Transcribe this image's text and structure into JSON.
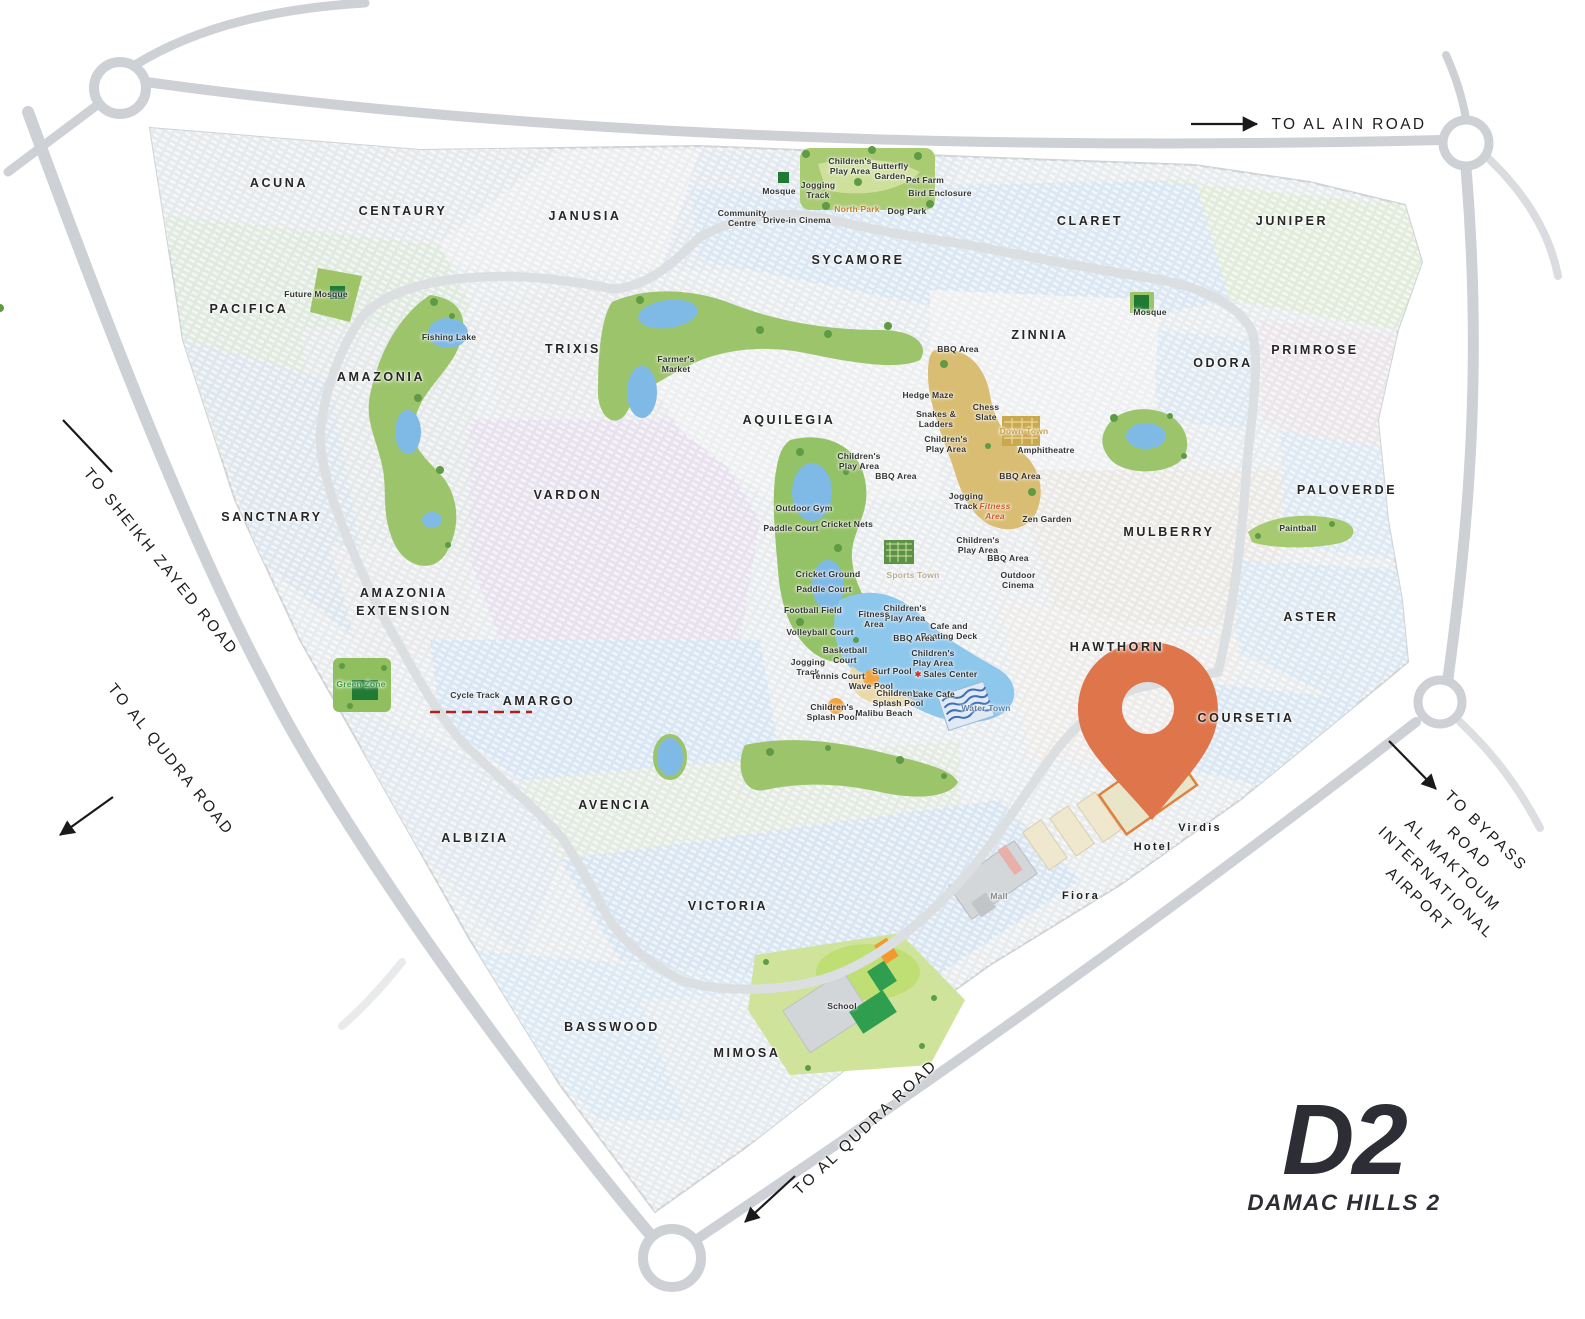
{
  "brand": {
    "logo_main": "D2",
    "logo_sub": "DAMAC HILLS 2"
  },
  "colors": {
    "pin": "#DE754B",
    "loop_dashed_road": "#B02020",
    "highway": "#CDD0D4",
    "park_green": "#9CC56B",
    "lake_blue": "#7FB9E6",
    "logo": "#2D2D35",
    "accent_orange_label": "#C2802F"
  },
  "clusters": [
    {
      "n": "ACUNA",
      "x": 279,
      "y": 183
    },
    {
      "n": "CENTAURY",
      "x": 403,
      "y": 211
    },
    {
      "n": "JANUSIA",
      "x": 585,
      "y": 216
    },
    {
      "n": "PACIFICA",
      "x": 249,
      "y": 309
    },
    {
      "n": "AMAZONIA",
      "x": 381,
      "y": 377
    },
    {
      "n": "TRIXIS",
      "x": 573,
      "y": 349
    },
    {
      "n": "SYCAMORE",
      "x": 858,
      "y": 260
    },
    {
      "n": "CLARET",
      "x": 1090,
      "y": 221
    },
    {
      "n": "JUNIPER",
      "x": 1292,
      "y": 221
    },
    {
      "n": "ZINNIA",
      "x": 1040,
      "y": 335
    },
    {
      "n": "ODORA",
      "x": 1223,
      "y": 363
    },
    {
      "n": "PRIMROSE",
      "x": 1315,
      "y": 350
    },
    {
      "n": "AQUILEGIA",
      "x": 789,
      "y": 420
    },
    {
      "n": "VARDON",
      "x": 568,
      "y": 495
    },
    {
      "n": "SANCTNARY",
      "x": 272,
      "y": 517
    },
    {
      "n": "MULBERRY",
      "x": 1169,
      "y": 532
    },
    {
      "n": "PALOVERDE",
      "x": 1347,
      "y": 490
    },
    {
      "n": "ASTER",
      "x": 1311,
      "y": 617
    },
    {
      "n": "AMAZONIA\nEXTENSION",
      "x": 404,
      "y": 602
    },
    {
      "n": "AMARGO",
      "x": 539,
      "y": 701
    },
    {
      "n": "HAWTHORN",
      "x": 1117,
      "y": 647
    },
    {
      "n": "COURSETIA",
      "x": 1246,
      "y": 718
    },
    {
      "n": "AVENCIA",
      "x": 615,
      "y": 805
    },
    {
      "n": "ALBIZIA",
      "x": 475,
      "y": 838
    },
    {
      "n": "VICTORIA",
      "x": 728,
      "y": 906
    },
    {
      "n": "BASSWOOD",
      "x": 612,
      "y": 1027
    },
    {
      "n": "MIMOSA",
      "x": 747,
      "y": 1053
    }
  ],
  "places": [
    {
      "n": "Virdis",
      "x": 1200,
      "y": 828
    },
    {
      "n": "Hotel",
      "x": 1153,
      "y": 847
    },
    {
      "n": "Fiora",
      "x": 1081,
      "y": 896
    }
  ],
  "amenities": [
    {
      "n": "Children's\nPlay Area",
      "x": 850,
      "y": 166
    },
    {
      "n": "Butterfly\nGarden",
      "x": 890,
      "y": 171
    },
    {
      "n": "Pet Farm",
      "x": 925,
      "y": 180
    },
    {
      "n": "Bird Enclosure",
      "x": 940,
      "y": 193
    },
    {
      "n": "Mosque",
      "x": 779,
      "y": 191
    },
    {
      "n": "Jogging\nTrack",
      "x": 818,
      "y": 190
    },
    {
      "n": "North Park",
      "x": 857,
      "y": 209,
      "c": "#c2802f"
    },
    {
      "n": "Dog Park",
      "x": 907,
      "y": 211
    },
    {
      "n": "Community\nCentre",
      "x": 742,
      "y": 218
    },
    {
      "n": "Drive-in Cinema",
      "x": 797,
      "y": 220
    },
    {
      "n": "Future Mosque",
      "x": 316,
      "y": 294
    },
    {
      "n": "Fishing Lake",
      "x": 449,
      "y": 337
    },
    {
      "n": "Mosque",
      "x": 1150,
      "y": 312
    },
    {
      "n": "Farmer's\nMarket",
      "x": 676,
      "y": 364
    },
    {
      "n": "BBQ Area",
      "x": 958,
      "y": 349
    },
    {
      "n": "Hedge Maze",
      "x": 928,
      "y": 395
    },
    {
      "n": "Chess\nSlate",
      "x": 986,
      "y": 412
    },
    {
      "n": "Down Town",
      "x": 1024,
      "y": 431,
      "c": "#c9a14e"
    },
    {
      "n": "Snakes &\nLadders",
      "x": 936,
      "y": 419
    },
    {
      "n": "Children's\nPlay Area",
      "x": 946,
      "y": 444
    },
    {
      "n": "Amphitheatre",
      "x": 1046,
      "y": 450
    },
    {
      "n": "BBQ Area",
      "x": 1020,
      "y": 476
    },
    {
      "n": "Children's\nPlay Area",
      "x": 859,
      "y": 461
    },
    {
      "n": "BBQ Area",
      "x": 896,
      "y": 476
    },
    {
      "n": "Outdoor Gym",
      "x": 804,
      "y": 508
    },
    {
      "n": "Jogging\nTrack",
      "x": 966,
      "y": 501
    },
    {
      "n": "Fitness\nArea",
      "x": 995,
      "y": 511,
      "c": "#cf5c2b",
      "i": 1
    },
    {
      "n": "Paddle Court",
      "x": 791,
      "y": 528
    },
    {
      "n": "Cricket Nets",
      "x": 847,
      "y": 524
    },
    {
      "n": "Zen Garden",
      "x": 1047,
      "y": 519
    },
    {
      "n": "Children's\nPlay Area",
      "x": 978,
      "y": 545
    },
    {
      "n": "BBQ Area",
      "x": 1008,
      "y": 558
    },
    {
      "n": "Cricket Ground",
      "x": 828,
      "y": 574
    },
    {
      "n": "Sports Town",
      "x": 913,
      "y": 575,
      "c": "#b9ab8e"
    },
    {
      "n": "Outdoor\nCinema",
      "x": 1018,
      "y": 580
    },
    {
      "n": "Paddle Court",
      "x": 824,
      "y": 589
    },
    {
      "n": "Football Field",
      "x": 813,
      "y": 610
    },
    {
      "n": "Children's\nPlay Area",
      "x": 905,
      "y": 613
    },
    {
      "n": "Fitness\nArea",
      "x": 874,
      "y": 619
    },
    {
      "n": "Cafe and\nBoating Deck",
      "x": 949,
      "y": 631
    },
    {
      "n": "Volleyball Court",
      "x": 820,
      "y": 632
    },
    {
      "n": "BBQ Area",
      "x": 914,
      "y": 638
    },
    {
      "n": "Basketball\nCourt",
      "x": 845,
      "y": 655
    },
    {
      "n": "Children's\nPlay Area",
      "x": 933,
      "y": 658
    },
    {
      "n": "Jogging\nTrack",
      "x": 808,
      "y": 667
    },
    {
      "n": "Surf Pool",
      "x": 892,
      "y": 671
    },
    {
      "n": "Sales Center",
      "x": 946,
      "y": 674,
      "icon": "star"
    },
    {
      "n": "Tennis Court",
      "x": 838,
      "y": 676
    },
    {
      "n": "Wave Pool",
      "x": 871,
      "y": 686
    },
    {
      "n": "Children's\nSplash Pool",
      "x": 898,
      "y": 698
    },
    {
      "n": "Lake Cafe",
      "x": 934,
      "y": 694
    },
    {
      "n": "Water Town",
      "x": 986,
      "y": 708,
      "c": "#5f7fa6"
    },
    {
      "n": "Children's\nSplash Pool",
      "x": 832,
      "y": 712
    },
    {
      "n": "Malibu Beach",
      "x": 884,
      "y": 713
    },
    {
      "n": "Green Zone",
      "x": 361,
      "y": 684,
      "c": "#3f9b41"
    },
    {
      "n": "Cycle Track",
      "x": 475,
      "y": 695
    },
    {
      "n": "Paintball",
      "x": 1298,
      "y": 528
    },
    {
      "n": "School",
      "x": 842,
      "y": 1006
    },
    {
      "n": "Mall",
      "x": 999,
      "y": 896,
      "c": "#8a8a8a"
    }
  ],
  "road_labels": [
    {
      "text": "TO AL AIN ROAD",
      "x": 1349,
      "y": 125,
      "rot": 0
    },
    {
      "text": "TO SHEIKH ZAYED ROAD",
      "x": 160,
      "y": 562,
      "rot": 51
    },
    {
      "text": "TO AL QUDRA ROAD",
      "x": 170,
      "y": 760,
      "rot": 51
    },
    {
      "text": "TO AL QUDRA ROAD",
      "x": 866,
      "y": 1128,
      "rot": -43
    },
    {
      "text": "TO BYPASS ROAD\nAL MAKTOUM\nINTERNATIONAL AIRPORT",
      "x": 1452,
      "y": 866,
      "rot": 44
    }
  ],
  "arrows": [
    {
      "x1": 1191,
      "y1": 124,
      "x2": 1257,
      "y2": 124,
      "head": true
    },
    {
      "x1": 1389,
      "y1": 741,
      "x2": 1436,
      "y2": 789,
      "head": true
    },
    {
      "x1": 795,
      "y1": 1176,
      "x2": 745,
      "y2": 1222,
      "head": true
    },
    {
      "x1": 113,
      "y1": 797,
      "x2": 60,
      "y2": 835,
      "head": true
    },
    {
      "x1": 63,
      "y1": 420,
      "x2": 112,
      "y2": 472,
      "head": false
    }
  ]
}
